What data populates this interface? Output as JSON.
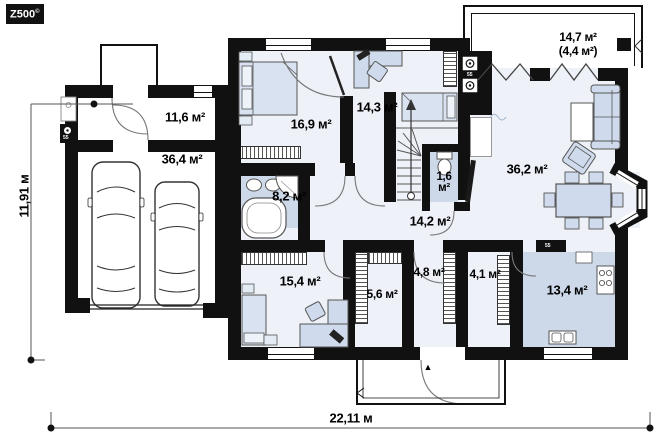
{
  "branding": {
    "logo": "Z500",
    "copyright": "©"
  },
  "dimensions": {
    "height": "11,91 м",
    "width": "22,11 м"
  },
  "rooms": {
    "mudroom": "11,6 м²",
    "garage": "36,4 м²",
    "bedroom1": "16,9 м²",
    "bedroom2": "14,3 м²",
    "terrace": "14,7 м²",
    "terrace_note": "(4,4 м²)",
    "bathroom": "8,2 м²",
    "wc": "1,6 м²",
    "living_room": "36,2 м²",
    "hallway": "14,2 м²",
    "bedroom3": "15,4 м²",
    "wardrobe": "5,6 м²",
    "pantry": "4,8 м²",
    "entry_hall": "4,1 м²",
    "kitchen": "13,4 м²"
  },
  "markers": {
    "flue": "55",
    "entry_arrow": "▲"
  },
  "colors": {
    "wall": "#111111",
    "floor": "#eef2f8",
    "wet_room": "#cdd9e9",
    "furniture": "#cfdbec"
  }
}
